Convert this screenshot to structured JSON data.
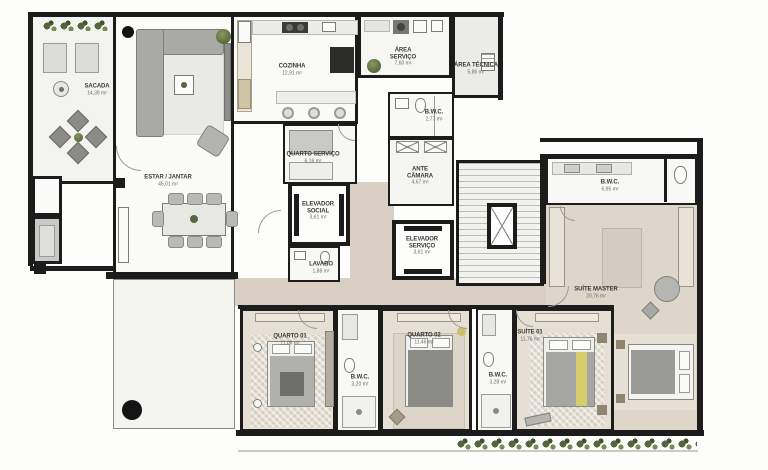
{
  "plan": {
    "rooms": [
      {
        "id": "sacada",
        "name": "SACADA",
        "area": "14,39 m²"
      },
      {
        "id": "estar-jantar",
        "name": "ESTAR / JANTAR",
        "area": "45,01 m²"
      },
      {
        "id": "cozinha",
        "name": "COZINHA",
        "area": "12,91 m²"
      },
      {
        "id": "area-servico",
        "name": "ÁREA\nSERVIÇO",
        "area": "7,60 m²"
      },
      {
        "id": "area-tecnica",
        "name": "ÁREA TÉCNICA",
        "area": "5,86 m²"
      },
      {
        "id": "bwc-servico",
        "name": "B.W.C.",
        "area": "2,77 m²"
      },
      {
        "id": "quarto-servico",
        "name": "QUARTO SERVIÇO",
        "area": "6,16 m²"
      },
      {
        "id": "ante-camara",
        "name": "ANTE\nCÂMARA",
        "area": "4,67 m²"
      },
      {
        "id": "elevador-social",
        "name": "ELEVADOR\nSOCIAL",
        "area": "3,61 m²"
      },
      {
        "id": "elevador-servico",
        "name": "ELEVADOR\nSERVIÇO",
        "area": "3,61 m²"
      },
      {
        "id": "lavabo",
        "name": "LAVABO",
        "area": "1,88 m²"
      },
      {
        "id": "bwc-master",
        "name": "B.W.C.",
        "area": "6,95 m²"
      },
      {
        "id": "suite-master",
        "name": "SUÍTE MASTER",
        "area": "20,76 m²"
      },
      {
        "id": "suite-01",
        "name": "SUÍTE 01",
        "area": "11,76 m²"
      },
      {
        "id": "bwc-suite-01",
        "name": "B.W.C.",
        "area": "3,28 m²"
      },
      {
        "id": "quarto-01",
        "name": "QUARTO 01",
        "area": "11,06 m²"
      },
      {
        "id": "bwc-quartos",
        "name": "B.W.C.",
        "area": "3,20 m²"
      },
      {
        "id": "quarto-02",
        "name": "QUARTO 02",
        "area": "11,46 m²"
      }
    ],
    "palette": {
      "wall": "#1c1c1c",
      "floor_social": "#f9f9f6",
      "floor_wood": "#e6dfd4",
      "corridor": "#d9cfc2",
      "accent_yellow": "#d6cd6e",
      "plant_green": "#5f6f41"
    }
  }
}
